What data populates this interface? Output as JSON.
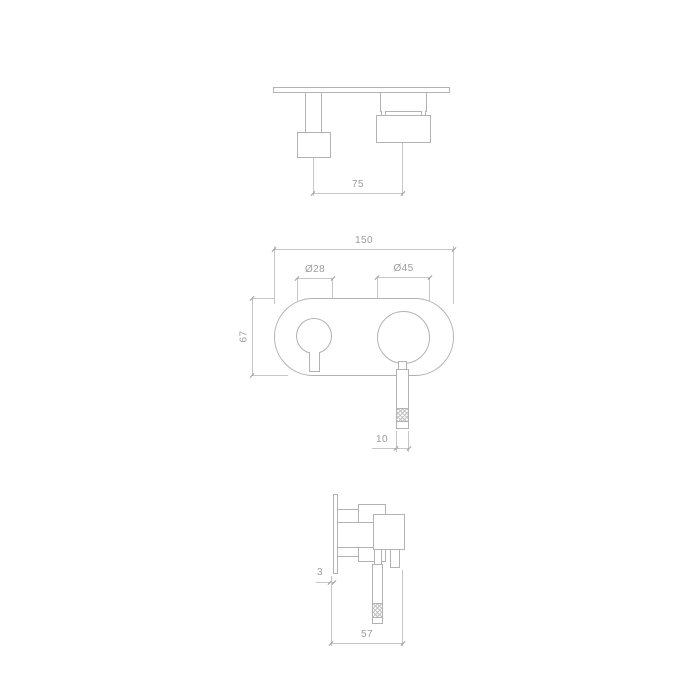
{
  "drawing": {
    "type": "technical-dimension-drawing",
    "subject": "wall-mounted two-handle mixer tap with oval backplate, shown in top, front and side views",
    "colors": {
      "outline": "#b2b2b2",
      "dimension_line": "#c6c6c6",
      "text": "#9c9c9c",
      "background": "#ffffff"
    },
    "views": {
      "top": {
        "name": "top view",
        "dims": {
          "handle_spacing": "75"
        }
      },
      "front": {
        "name": "front view",
        "dims": {
          "plate_width": "150",
          "small_knob_diameter": "Ø28",
          "large_knob_diameter": "Ø45",
          "plate_height": "67",
          "lever_width": "10"
        }
      },
      "side": {
        "name": "side view",
        "dims": {
          "plate_thickness": "3",
          "total_depth": "57"
        }
      }
    }
  }
}
